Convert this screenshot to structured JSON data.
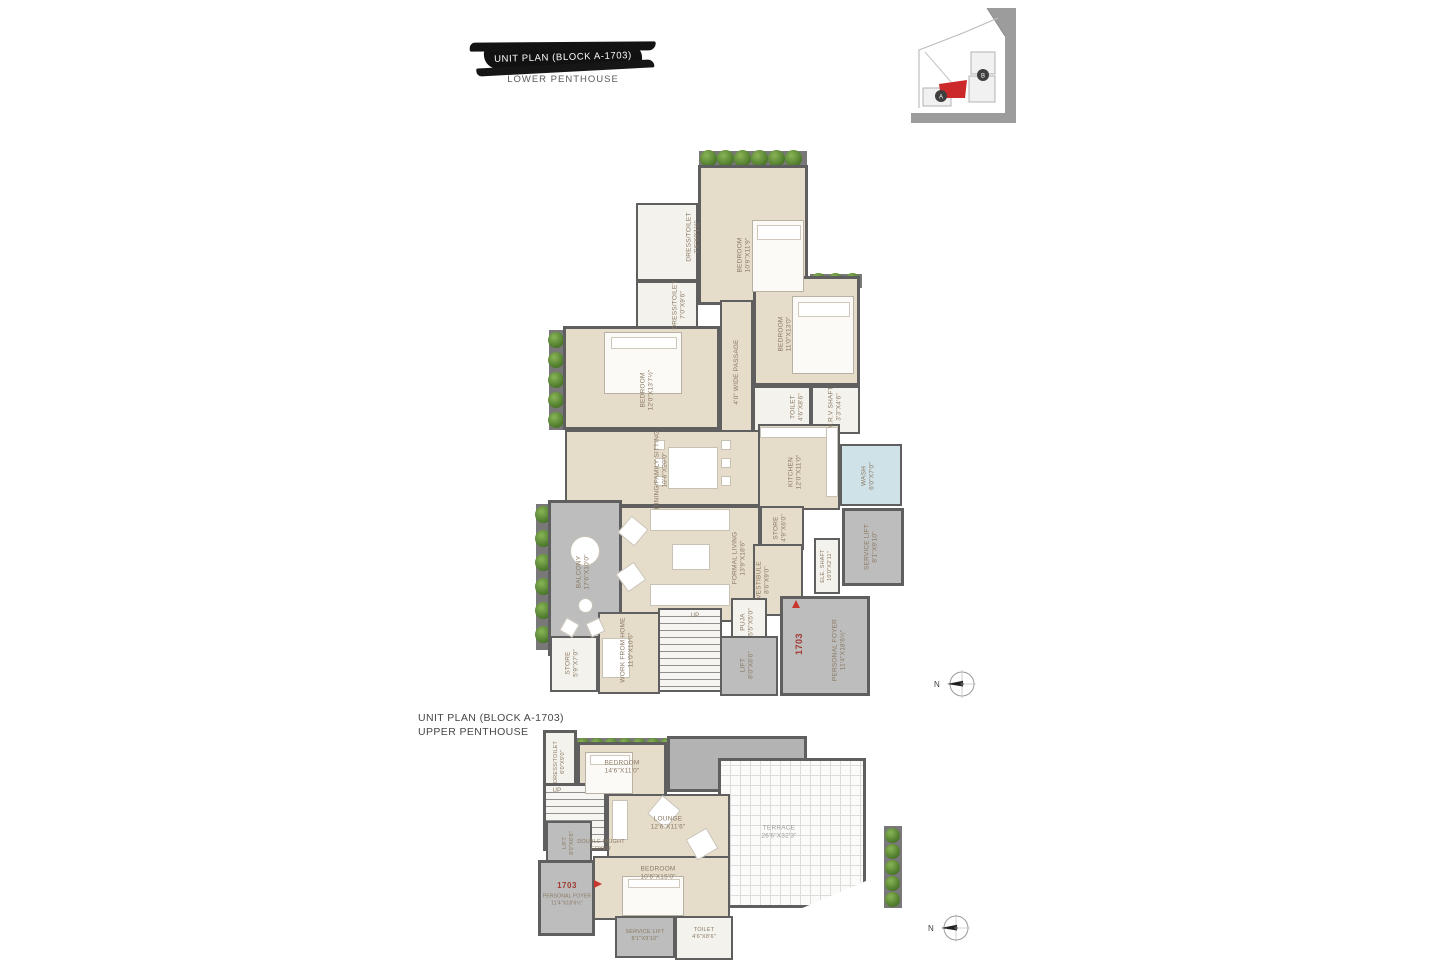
{
  "lower_title": {
    "line1": "UNIT PLAN (BLOCK A-1703)",
    "line2": "LOWER PENTHOUSE"
  },
  "upper_title": {
    "line1": "UNIT PLAN (BLOCK A-1703)",
    "line2": "UPPER PENTHOUSE"
  },
  "key_plan": {
    "block_a_label": "A",
    "block_b_label": "B"
  },
  "compass_label": "N",
  "colors": {
    "wall": "#5f5f5f",
    "room_fill": "#e6dcca",
    "gray_fill": "#bdbdbd",
    "wash_blue": "#cfe2e8",
    "tree_green": "#4d7a2b",
    "accent_red": "#c8372d",
    "label_brown": "#8a7963"
  },
  "lower_plan": {
    "unit_number": "1703",
    "bedroom_top": {
      "name": "BEDROOM",
      "dim": "10'9\"X11'9\""
    },
    "dress_toilet_1": {
      "name": "DRESS/TOILET",
      "dim": "7'6\"X9'1½\""
    },
    "dress_toilet_2": {
      "name": "DRESS/TOILET",
      "dim": "7'0\"X9'6\""
    },
    "bedroom_right": {
      "name": "BEDROOM",
      "dim": "11'0\"X13'0\""
    },
    "toilet_right": {
      "name": "TOILET",
      "dim": "4'6\"X8'6\""
    },
    "vrv_shaft": {
      "name": "V.R.V SHAFT",
      "dim": "3'3\"X4'6\""
    },
    "passage": {
      "name": "4'0\" WIDE PASSAGE"
    },
    "bedroom_left": {
      "name": "BEDROOM",
      "dim": "12'0\"X13'7½\""
    },
    "dining": {
      "name": "DINING/FAMILY SITTING",
      "dim": "10'6\"X20'0\""
    },
    "kitchen": {
      "name": "KITCHEN",
      "dim": "12'0\"X11'0\""
    },
    "wash": {
      "name": "WASH",
      "dim": "6'0\"X7'0\""
    },
    "store_1": {
      "name": "STORE",
      "dim": "4'9\"X6'0\""
    },
    "service_lift": {
      "name": "SERVICE LIFT",
      "dim": "8'1\"X9'10\""
    },
    "ele_shaft": {
      "name": "ELE. SHAFT",
      "dim": "10'0\"X2'11\""
    },
    "formal_living": {
      "name": "FORMAL LIVING",
      "dim": "13'9\"X18'6\""
    },
    "balcony": {
      "name": "BALCONY",
      "dim": "17'6\"X10'0\""
    },
    "vestibule": {
      "name": "VESTIBULE",
      "dim": "8'6\"X9'0\""
    },
    "puja": {
      "name": "PUJA",
      "dim": "5'5\"X5'0\""
    },
    "stairs_label": "UP",
    "work_from_home": {
      "name": "WORK FROM HOME",
      "dim": "11'0\"X10'6\""
    },
    "store_2": {
      "name": "STORE",
      "dim": "5'9\"X7'0\""
    },
    "lift": {
      "name": "LIFT",
      "dim": "8'0\"X6'6\""
    },
    "personal_foyer": {
      "name": "PERSONAL FOYER",
      "dim": "11'4\"X18'6½\""
    }
  },
  "upper_plan": {
    "unit_number": "1703",
    "dress_toilet": {
      "name": "DRESS/TOILET",
      "dim": "6'0\"X9'0\""
    },
    "bedroom_top": {
      "name": "BEDROOM",
      "dim": "14'6\"X11'0\""
    },
    "lounge": {
      "name": "LOUNGE",
      "dim": "12'6\"X11'6\""
    },
    "terrace": {
      "name": "TERRACE",
      "dim": "26'6\"X32'3\""
    },
    "bedroom_low": {
      "name": "BEDROOM",
      "dim": "10'6\"X15'0\""
    },
    "lift": {
      "name": "LIFT",
      "dim": "8'0\"X6'6\""
    },
    "double_height_foyer": {
      "name": "DOUBLE HEIGHT",
      "dim": "FOYER"
    },
    "personal_foyer": {
      "name": "PERSONAL FOYER",
      "dim": "11'4\"X18'6½\""
    },
    "service_lift": {
      "name": "SERVICE LIFT",
      "dim": "8'1\"X9'10\""
    },
    "toilet": {
      "name": "TOILET",
      "dim": "4'6\"X8'6\""
    },
    "stairs_label": "UP"
  }
}
